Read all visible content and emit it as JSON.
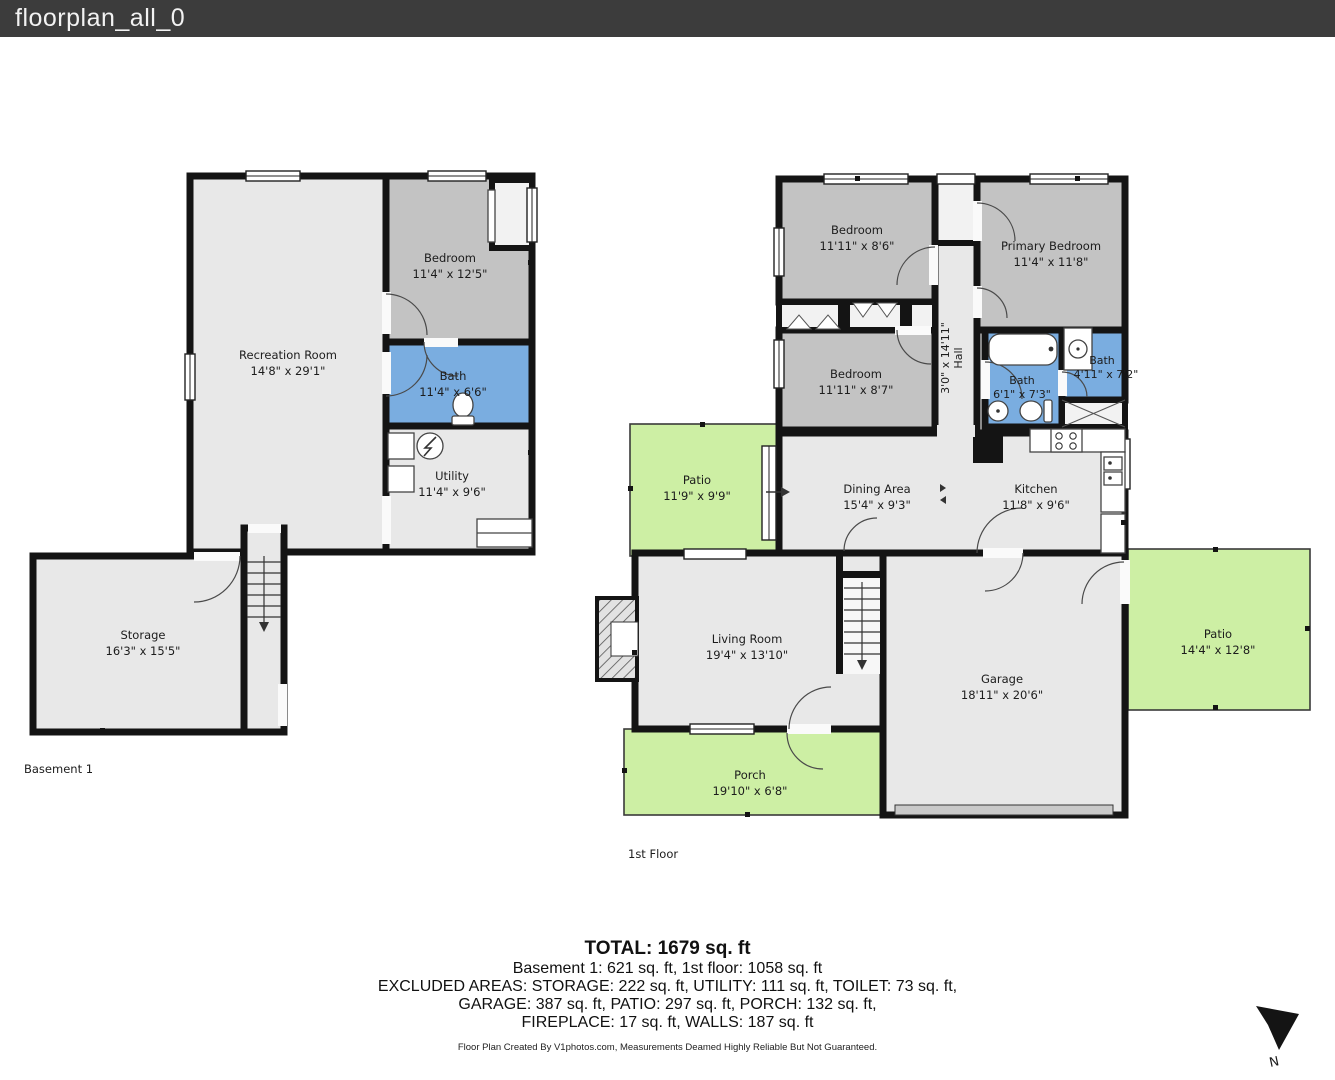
{
  "header": {
    "title": "floorplan_all_0"
  },
  "basement": {
    "floor_label": "Basement 1",
    "recreation": {
      "name": "Recreation Room",
      "dims": "14'8\" x 29'1\""
    },
    "bedroom": {
      "name": "Bedroom",
      "dims": "11'4\" x 12'5\""
    },
    "bath": {
      "name": "Bath",
      "dims": "11'4\" x 6'6\""
    },
    "utility": {
      "name": "Utility",
      "dims": "11'4\" x 9'6\""
    },
    "storage": {
      "name": "Storage",
      "dims": "16'3\" x 15'5\""
    }
  },
  "first_floor": {
    "floor_label": "1st Floor",
    "bedroom_top": {
      "name": "Bedroom",
      "dims": "11'11\" x 8'6\""
    },
    "primary_bedroom": {
      "name": "Primary Bedroom",
      "dims": "11'4\" x 11'8\""
    },
    "hall": {
      "name": "Hall",
      "dims": "3'0\" x 14'11\""
    },
    "bedroom_mid": {
      "name": "Bedroom",
      "dims": "11'11\" x 8'7\""
    },
    "bath_main": {
      "name": "Bath",
      "dims": "6'1\" x 7'3\""
    },
    "bath_small": {
      "name": "Bath",
      "dims": "4'11\" x 7'2\""
    },
    "patio_left": {
      "name": "Patio",
      "dims": "11'9\" x 9'9\""
    },
    "dining": {
      "name": "Dining Area",
      "dims": "15'4\" x 9'3\""
    },
    "kitchen": {
      "name": "Kitchen",
      "dims": "11'8\" x 9'6\""
    },
    "living": {
      "name": "Living Room",
      "dims": "19'4\" x 13'10\""
    },
    "garage": {
      "name": "Garage",
      "dims": "18'11\" x 20'6\""
    },
    "patio_right": {
      "name": "Patio",
      "dims": "14'4\" x 12'8\""
    },
    "porch": {
      "name": "Porch",
      "dims": "19'10\" x 6'8\""
    }
  },
  "summary": {
    "total": "TOTAL: 1679 sq. ft",
    "floors_line": "Basement 1: 621 sq. ft, 1st floor: 1058 sq. ft",
    "excluded_line1": "EXCLUDED AREAS: STORAGE: 222 sq. ft, UTILITY: 111 sq. ft, TOILET: 73 sq. ft,",
    "excluded_line2": "GARAGE: 387 sq. ft, PATIO: 297 sq. ft, PORCH: 132 sq. ft,",
    "excluded_line3": "FIREPLACE: 17 sq. ft, WALLS: 187 sq. ft"
  },
  "footer": {
    "credit": "Floor Plan Created By V1photos.com, Measurements Deamed Highly Reliable But Not Guaranteed."
  },
  "compass": {
    "label": "N"
  },
  "colors": {
    "topbar": "#3c3c3c",
    "wall": "#141414",
    "floor_light": "#e8e8e8",
    "floor_dark": "#c3c3c3",
    "bath_blue": "#7aade0",
    "outdoor_green": "#cdefa4"
  }
}
